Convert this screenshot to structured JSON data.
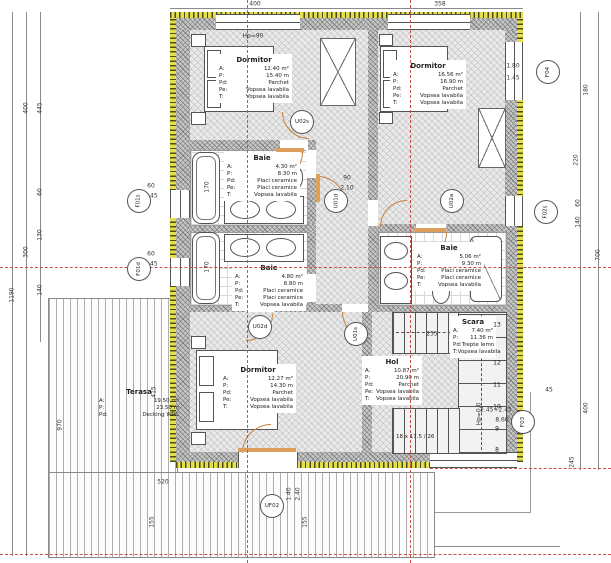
{
  "drawing": {
    "spec_labels": {
      "area": "A:",
      "perimeter": "P:",
      "floor": "Pd:",
      "walls": "Pe:",
      "ceiling": "T:"
    },
    "rooms": {
      "dormitor_nv": {
        "name": "Dormitor",
        "a": "12.40 m²",
        "p": "15.40 m",
        "pd": "Parchet",
        "pe": "Vopsea lavabila",
        "t": "Vopsea lavabila"
      },
      "dormitor_ne": {
        "name": "Dormitor",
        "a": "16.56 m²",
        "p": "16.90 m",
        "pd": "Parchet",
        "pe": "Vopsea lavabila",
        "t": "Vopsea lavabila"
      },
      "baie_s": {
        "name": "Baie",
        "a": "4.30 m²",
        "p": "8.30 m",
        "pd": "Placi ceramice",
        "pe": "Placi ceramice",
        "t": "Vopsea lavabila"
      },
      "baie_m": {
        "name": "Baie",
        "a": "4.80 m²",
        "p": "8.80 m",
        "pd": "Placi ceramice",
        "pe": "Placi ceramice",
        "t": "Vopsea lavabila"
      },
      "baie_d": {
        "name": "Baie",
        "a": "5.06 m²",
        "p": "9.30 m",
        "pd": "Placi ceramice",
        "pe": "Placi ceramice",
        "t": "Vopsea lavabila"
      },
      "dormitor_sv": {
        "name": "Dormitor",
        "a": "12.27 m²",
        "p": "14.30 m",
        "pd": "Parchet",
        "pe": "Vopsea lavabila",
        "t": "Vopsea lavabila"
      },
      "hol": {
        "name": "Hol",
        "a": "10.87 m²",
        "p": "20.90 m",
        "pd": "Parchet",
        "pe": "Vopsea lavabila",
        "t": "Vopsea lavabila"
      },
      "scara": {
        "name": "Scara",
        "a": "7.40 m²",
        "p": "11.36 m",
        "pd": "Trepte lemn",
        "t": "Vopsea lavabila"
      },
      "terasa": {
        "name": "Terasa",
        "a": "19.50 m²",
        "p": "23.50 m",
        "pd": "Decking WPC"
      }
    },
    "tags": [
      {
        "label": "U02s",
        "x": 302,
        "y": 122,
        "rot": 0
      },
      {
        "label": "U01d",
        "x": 336,
        "y": 201,
        "rot": -90
      },
      {
        "label": "U02a",
        "x": 452,
        "y": 201,
        "rot": -90
      },
      {
        "label": "U02d",
        "x": 260,
        "y": 327,
        "rot": 0
      },
      {
        "label": "U01s",
        "x": 356,
        "y": 334,
        "rot": -90
      },
      {
        "label": "UF02",
        "x": 272,
        "y": 506,
        "rot": 0
      },
      {
        "label": "F01s",
        "x": 139,
        "y": 201,
        "rot": -90
      },
      {
        "label": "F01d",
        "x": 139,
        "y": 269,
        "rot": -90
      },
      {
        "label": "F04",
        "x": 548,
        "y": 72,
        "rot": -90
      },
      {
        "label": "F02s",
        "x": 546,
        "y": 212,
        "rot": -90
      },
      {
        "label": "F03",
        "x": 523,
        "y": 422,
        "rot": -90
      }
    ],
    "dims": [
      {
        "text": "400",
        "x": 255,
        "y": 4,
        "rot": 0
      },
      {
        "text": "358",
        "x": 440,
        "y": 4,
        "rot": 0
      },
      {
        "text": "Hp=90",
        "x": 253,
        "y": 36,
        "rot": 0
      },
      {
        "text": "445",
        "x": 40,
        "y": 108,
        "rot": -90
      },
      {
        "text": "400",
        "x": 26,
        "y": 108,
        "rot": -90
      },
      {
        "text": "1190",
        "x": 12,
        "y": 295,
        "rot": -90
      },
      {
        "text": "300",
        "x": 26,
        "y": 252,
        "rot": -90
      },
      {
        "text": "60",
        "x": 40,
        "y": 192,
        "rot": -90
      },
      {
        "text": "130",
        "x": 40,
        "y": 235,
        "rot": -90
      },
      {
        "text": "140",
        "x": 40,
        "y": 290,
        "rot": -90
      },
      {
        "text": "60",
        "x": 151,
        "y": 186,
        "rot": 0
      },
      {
        "text": "1.45",
        "x": 151,
        "y": 196,
        "rot": 0
      },
      {
        "text": "60",
        "x": 151,
        "y": 254,
        "rot": 0
      },
      {
        "text": "1.45",
        "x": 151,
        "y": 264,
        "rot": 0
      },
      {
        "text": "170",
        "x": 207,
        "y": 187,
        "rot": -90
      },
      {
        "text": "170",
        "x": 207,
        "y": 267,
        "rot": -90
      },
      {
        "text": "970",
        "x": 60,
        "y": 425,
        "rot": -90
      },
      {
        "text": "415",
        "x": 154,
        "y": 392,
        "rot": -90
      },
      {
        "text": "180",
        "x": 586,
        "y": 90,
        "rot": -90
      },
      {
        "text": "1.80",
        "x": 513,
        "y": 66,
        "rot": 0
      },
      {
        "text": "1.45",
        "x": 513,
        "y": 78,
        "rot": 0
      },
      {
        "text": "220",
        "x": 576,
        "y": 160,
        "rot": -90
      },
      {
        "text": "700",
        "x": 598,
        "y": 255,
        "rot": -90
      },
      {
        "text": "60",
        "x": 578,
        "y": 203,
        "rot": -90
      },
      {
        "text": "140",
        "x": 578,
        "y": 222,
        "rot": -90
      },
      {
        "text": "45",
        "x": 549,
        "y": 390,
        "rot": 0
      },
      {
        "text": "400",
        "x": 586,
        "y": 408,
        "rot": -90
      },
      {
        "text": "245",
        "x": 572,
        "y": 462,
        "rot": -90
      },
      {
        "text": "2.45+2.45",
        "x": 496,
        "y": 410,
        "rot": 0
      },
      {
        "text": "8.60",
        "x": 502,
        "y": 420,
        "rot": 0
      },
      {
        "text": "Hp=0,0",
        "x": 479,
        "y": 414,
        "rot": -90
      },
      {
        "text": "90",
        "x": 347,
        "y": 178,
        "rot": 0
      },
      {
        "text": "2.10",
        "x": 347,
        "y": 188,
        "rot": 0
      },
      {
        "text": "255",
        "x": 432,
        "y": 334,
        "rot": 0
      },
      {
        "text": "520",
        "x": 163,
        "y": 482,
        "rot": 0
      },
      {
        "text": "1.40",
        "x": 289,
        "y": 494,
        "rot": -90
      },
      {
        "text": "2.40",
        "x": 298,
        "y": 494,
        "rot": -90
      },
      {
        "text": "155",
        "x": 152,
        "y": 522,
        "rot": -90
      },
      {
        "text": "155",
        "x": 305,
        "y": 522,
        "rot": -90
      }
    ],
    "stairs": {
      "note": "18 x 17.5 / 26",
      "steps_x": 497,
      "steps": [
        {
          "n": "13",
          "y": 325
        },
        {
          "n": "12",
          "y": 363
        },
        {
          "n": "11",
          "y": 385
        },
        {
          "n": "10",
          "y": 407
        },
        {
          "n": "9",
          "y": 429
        },
        {
          "n": "8",
          "y": 450
        }
      ]
    },
    "colors": {
      "insulation": "#e3df4e",
      "wall_hatch": "#c6c6c6",
      "centerline": "#c9504a",
      "door": "#c9823c",
      "dim_text": "#333333"
    }
  }
}
